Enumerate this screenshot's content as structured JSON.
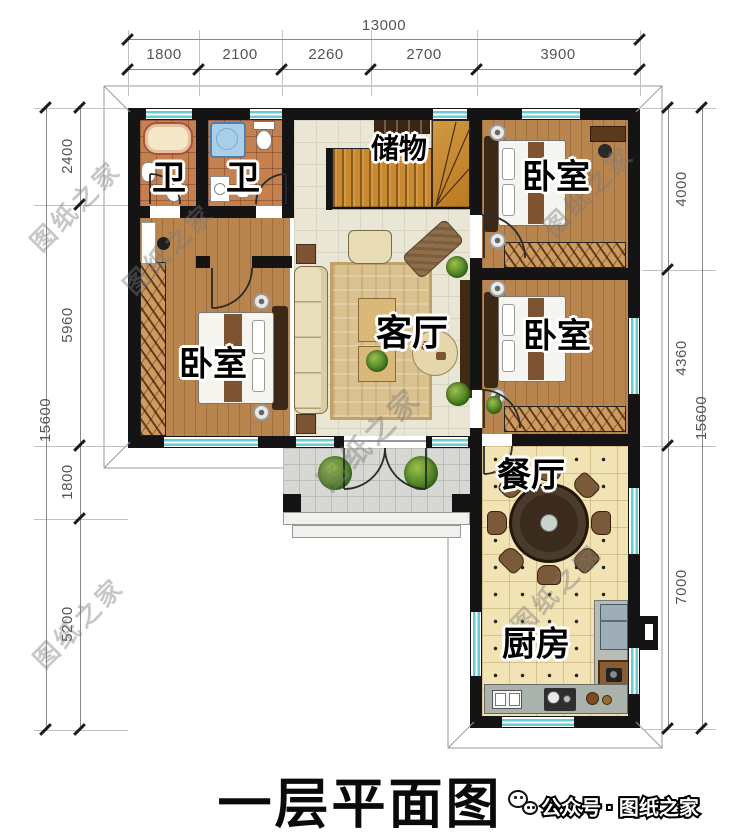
{
  "page": {
    "title": "一层平面图",
    "publisher": "公众号 · 图纸之家",
    "watermark": "图纸之家"
  },
  "dimensions": {
    "top": {
      "total": "13000",
      "segments": [
        "1800",
        "2100",
        "2260",
        "2700",
        "3900"
      ]
    },
    "left": {
      "total": "15600",
      "segments": [
        "2400",
        "5960",
        "1800",
        "5200"
      ]
    },
    "right": {
      "total": "15600",
      "segments": [
        "4000",
        "4360",
        "7000"
      ]
    }
  },
  "rooms": {
    "bathroom_1": "卫",
    "bathroom_2": "卫",
    "storage": "储物",
    "bedroom_top_right": "卧室",
    "bedroom_left": "卧室",
    "bedroom_mid_right": "卧室",
    "living_room": "客厅",
    "dining_room": "餐厅",
    "kitchen": "厨房"
  },
  "colors": {
    "wall": "#141414",
    "window": "#66ccd2",
    "bath_tile": "#c5804f",
    "wood_floor": "#b9854e",
    "hall_tile": "#eae6d6",
    "kitchen_tile": "#f2e3b4",
    "porch_tile": "#d7d8d3",
    "stair_wood": "#c9892f",
    "dining_table": "#3b2b1c"
  }
}
